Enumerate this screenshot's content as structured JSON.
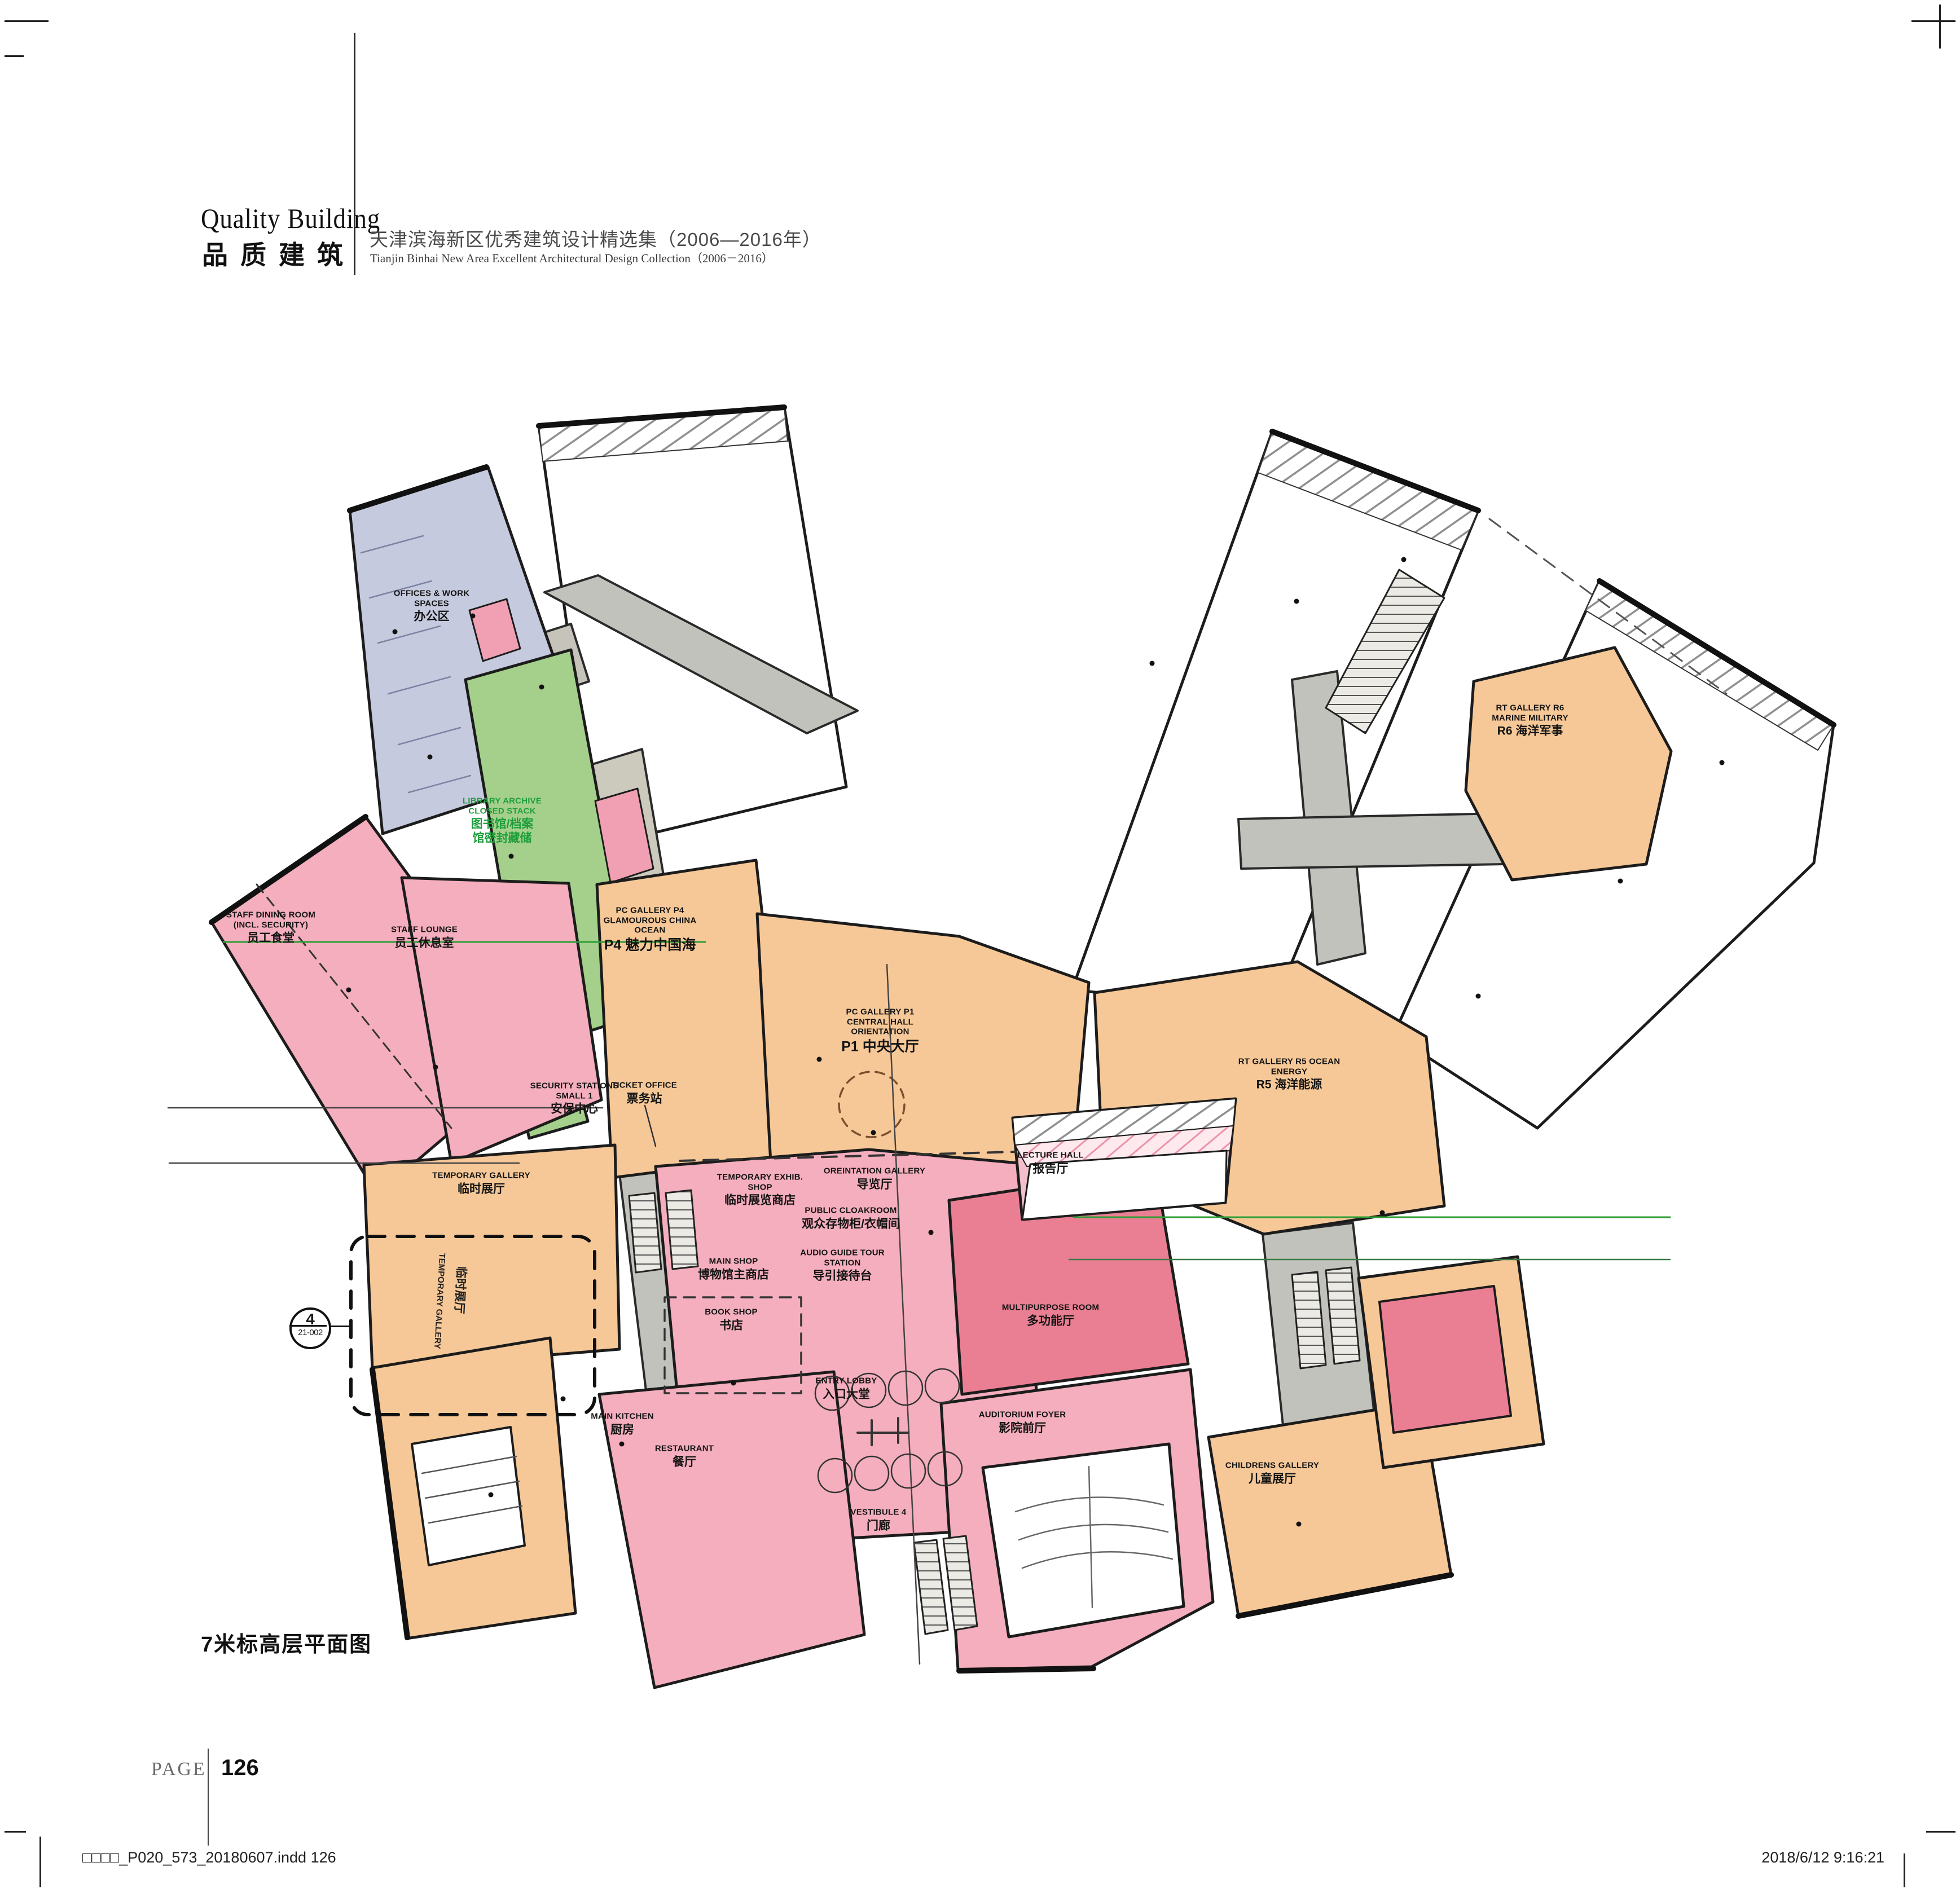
{
  "header": {
    "title_en": "Quality Building",
    "title_zh": "品质建筑",
    "subtitle_zh": "天津滨海新区优秀建筑设计精选集（2006—2016年）",
    "subtitle_en": "Tianjin Binhai New Area Excellent Architectural Design Collection（2006－2016）"
  },
  "plan": {
    "caption": "7米标高层平面图",
    "callout": {
      "number": "4",
      "code": "21-002"
    },
    "legend_colors": {
      "public_gallery_orange": "#f6c897",
      "visitor_services_pink": "#f4aebd",
      "event_rose": "#ea7f93",
      "library_green": "#a5d08b",
      "offices_lavender": "#c6cade",
      "core_gray": "#c2c2bc",
      "wall_black": "#1a1a1a",
      "label_green": "#1f9e3c"
    },
    "rooms": [
      {
        "id": "offices",
        "en": "OFFICES & WORK\nSPACES",
        "zh": "办公区"
      },
      {
        "id": "library",
        "en": "LIBRARY ARCHIVE\nCLOSED STACK",
        "zh": "图书馆/档案\n馆密封藏储"
      },
      {
        "id": "staff-dining",
        "en": "STAFF DINING ROOM\n(INCL. SECURITY)",
        "zh": "员工食堂"
      },
      {
        "id": "staff-lounge",
        "en": "STAFF LOUNGE",
        "zh": "员工休息室"
      },
      {
        "id": "pc-gallery-p4",
        "en": "PC GALLERY P4\nGLAMOUROUS CHINA\nOCEAN",
        "zh": "P4 魅力中国海"
      },
      {
        "id": "pc-gallery-p1",
        "en": "PC GALLERY P1\nCENTRAL HALL\nORIENTATION",
        "zh": "P1 中央大厅"
      },
      {
        "id": "security",
        "en": "SECURITY STATIONS\nSMALL 1",
        "zh": "安保中心"
      },
      {
        "id": "ticket-office",
        "en": "TICKET OFFICE",
        "zh": "票务站"
      },
      {
        "id": "temp-gallery",
        "en": "TEMPORARY GALLERY",
        "zh": "临时展厅"
      },
      {
        "id": "temp-shop",
        "en": "TEMPORARY EXHIB.\nSHOP",
        "zh": "临时展览商店"
      },
      {
        "id": "orientation",
        "en": "OREINTATION GALLERY",
        "zh": "导览厅"
      },
      {
        "id": "cloakroom",
        "en": "PUBLIC CLOAKROOM",
        "zh": "观众存物柜/衣帽间"
      },
      {
        "id": "audio-guide",
        "en": "AUDIO GUIDE TOUR\nSTATION",
        "zh": "导引接待台"
      },
      {
        "id": "main-shop",
        "en": "MAIN SHOP",
        "zh": "博物馆主商店"
      },
      {
        "id": "book-shop",
        "en": "BOOK SHOP",
        "zh": "书店"
      },
      {
        "id": "entry-lobby",
        "en": "ENTRY LOBBY",
        "zh": "入口大堂"
      },
      {
        "id": "vestibule-4",
        "en": "VESTIBULE 4",
        "zh": "门廊"
      },
      {
        "id": "main-kitchen",
        "en": "MAIN KITCHEN",
        "zh": "厨房"
      },
      {
        "id": "restaurant",
        "en": "RESTAURANT",
        "zh": "餐厅"
      },
      {
        "id": "auditorium-foyer",
        "en": "AUDITORIUM FOYER",
        "zh": "影院前厅"
      },
      {
        "id": "multipurpose",
        "en": "MULTIPURPOSE ROOM",
        "zh": "多功能厅"
      },
      {
        "id": "lecture-hall",
        "en": "LECTURE HALL",
        "zh": "报告厅"
      },
      {
        "id": "rt-gallery-r5",
        "en": "RT GALLERY R5 OCEAN\nENERGY",
        "zh": "R5 海洋能源"
      },
      {
        "id": "rt-gallery-r6",
        "en": "RT GALLERY R6\nMARINE MILITARY",
        "zh": "R6 海洋军事"
      },
      {
        "id": "childrens",
        "en": "CHILDRENS GALLERY",
        "zh": "儿童展厅"
      },
      {
        "id": "temp-gallery-vertical",
        "en": "TEMPORARY GALLERY",
        "zh": "临时展厅"
      }
    ]
  },
  "footer": {
    "page_label": "PAGE",
    "page_number": "126",
    "print_file": "□□□□_P020_573_20180607.indd   126",
    "print_datetime": "2018/6/12   9:16:21"
  }
}
